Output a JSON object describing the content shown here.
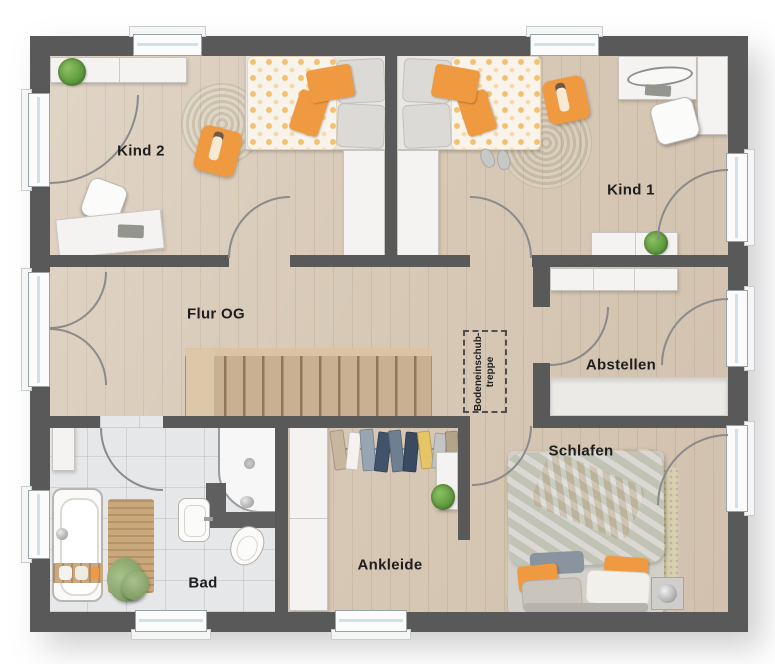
{
  "rooms": {
    "kind2": {
      "label": "Kind 2"
    },
    "kind1": {
      "label": "Kind 1"
    },
    "flur": {
      "label": "Flur OG"
    },
    "abstellen": {
      "label": "Abstellen"
    },
    "schlafen": {
      "label": "Schlafen"
    },
    "ankleide": {
      "label": "Ankleide"
    },
    "bad": {
      "label": "Bad"
    }
  },
  "annotations": {
    "attic_stairs_line1": "Bodeneinschub-",
    "attic_stairs_line2": "treppe"
  },
  "colors": {
    "wall": "#595959",
    "wood_floor": "#d8c9b7",
    "tile_floor": "#e5e7e8",
    "stair_wood": "#c9b092",
    "rug_green": "#aec489",
    "accent_orange": "#ef9a40",
    "bed_green": "#b7cfa0",
    "window_glass": "#cfe2ea",
    "door_arc": "#8b8b8b"
  }
}
